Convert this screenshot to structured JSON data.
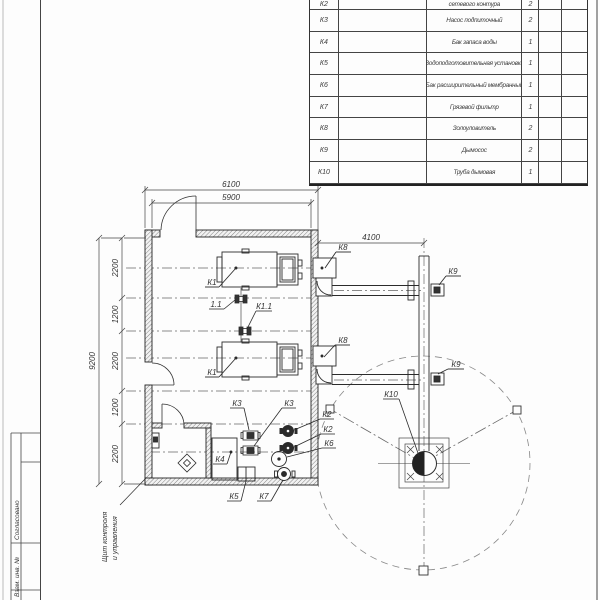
{
  "equipment_table": {
    "partial_top_row": {
      "pos": "К2",
      "name_visible": "сетевого контура",
      "qty": "2"
    },
    "rows": [
      {
        "pos": "К3",
        "name": "Насос подпиточный",
        "qty": "2"
      },
      {
        "pos": "К4",
        "name": "Бак запаса воды",
        "qty": "1"
      },
      {
        "pos": "К5",
        "name": "Водоподготовительная установка",
        "qty": "1"
      },
      {
        "pos": "К6",
        "name": "Бак расширительный мембранный",
        "qty": "1"
      },
      {
        "pos": "К7",
        "name": "Грязевой фильтр",
        "qty": "1"
      },
      {
        "pos": "К8",
        "name": "Золоуловитель",
        "qty": "2"
      },
      {
        "pos": "К9",
        "name": "Дымосос",
        "qty": "2"
      },
      {
        "pos": "К10",
        "name": "Труба дымовая",
        "qty": "1"
      }
    ]
  },
  "dimensions": {
    "overall_width": "6100",
    "inner_width": "5900",
    "chimney_offset": "4100",
    "overall_height": "9200",
    "left_chain": [
      "2200",
      "1200",
      "2200",
      "1200",
      "2200"
    ]
  },
  "callouts": {
    "boiler": "К1",
    "valve_a": "1.1",
    "valve_b": "К1.1",
    "network_pump": "К2",
    "feed_pump": "К3",
    "water_tank": "К4",
    "water_treatment": "К5",
    "expansion_tank": "К6",
    "dirt_filter": "К7",
    "ash_collector": "К8",
    "smoke_exhauster": "К9",
    "chimney": "К10"
  },
  "notes": {
    "control_panel_line1": "Щит контроля",
    "control_panel_line2": "и управления"
  },
  "frame_strip": {
    "approved_label": "Согласовано",
    "inventory_label": "Взам. инв. №"
  }
}
